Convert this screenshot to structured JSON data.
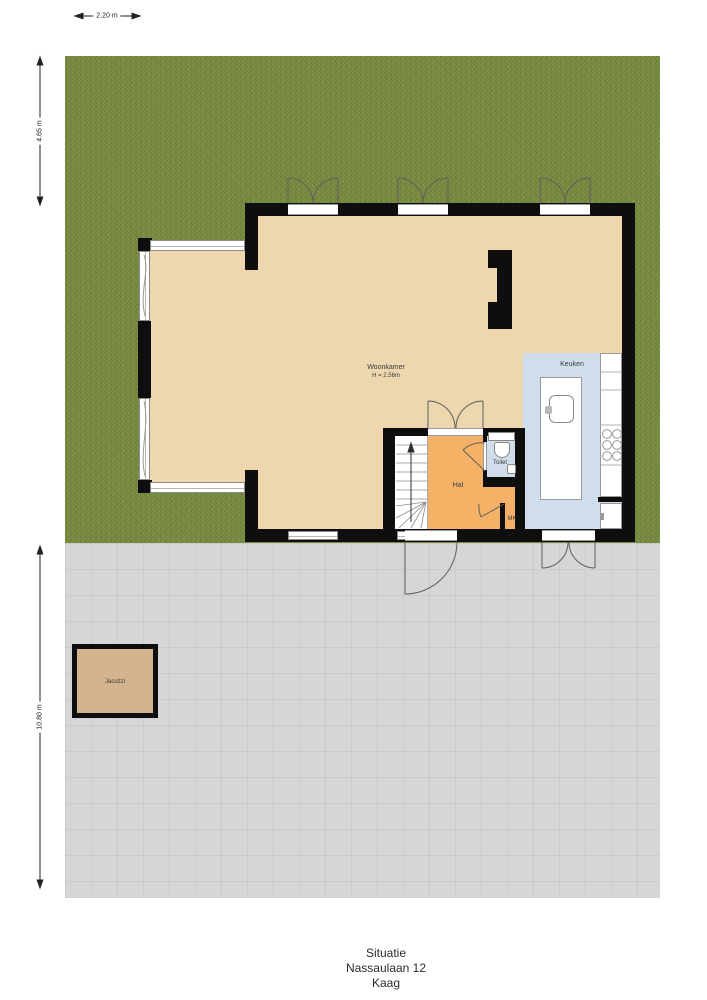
{
  "title": {
    "lines": [
      "Situatie",
      "Nassaulaan 12",
      "Kaag"
    ]
  },
  "dimensions": {
    "garden_width": "2.20 m",
    "garden_depth": "4.65 m",
    "terrace_depth": "10.80 m"
  },
  "rooms": {
    "woonkamer": {
      "label": "Woonkamer",
      "ceiling_height": "H = 2.56m"
    },
    "keuken": {
      "label": "Keuken"
    },
    "hal": {
      "label": "Hal"
    },
    "toilet": {
      "label": "Toilet"
    },
    "mk": {
      "label": "MK"
    },
    "jacuzzi": {
      "label": "Jacuzzi"
    }
  },
  "colors": {
    "grass": "#7c8f45",
    "terrace": "#d6d6d6",
    "floor": "#eed7ae",
    "hal": "#f5b266",
    "kitchen": "#cfdeea",
    "jacuzzi": "#d3b48e",
    "wall": "#0e0e0e"
  }
}
